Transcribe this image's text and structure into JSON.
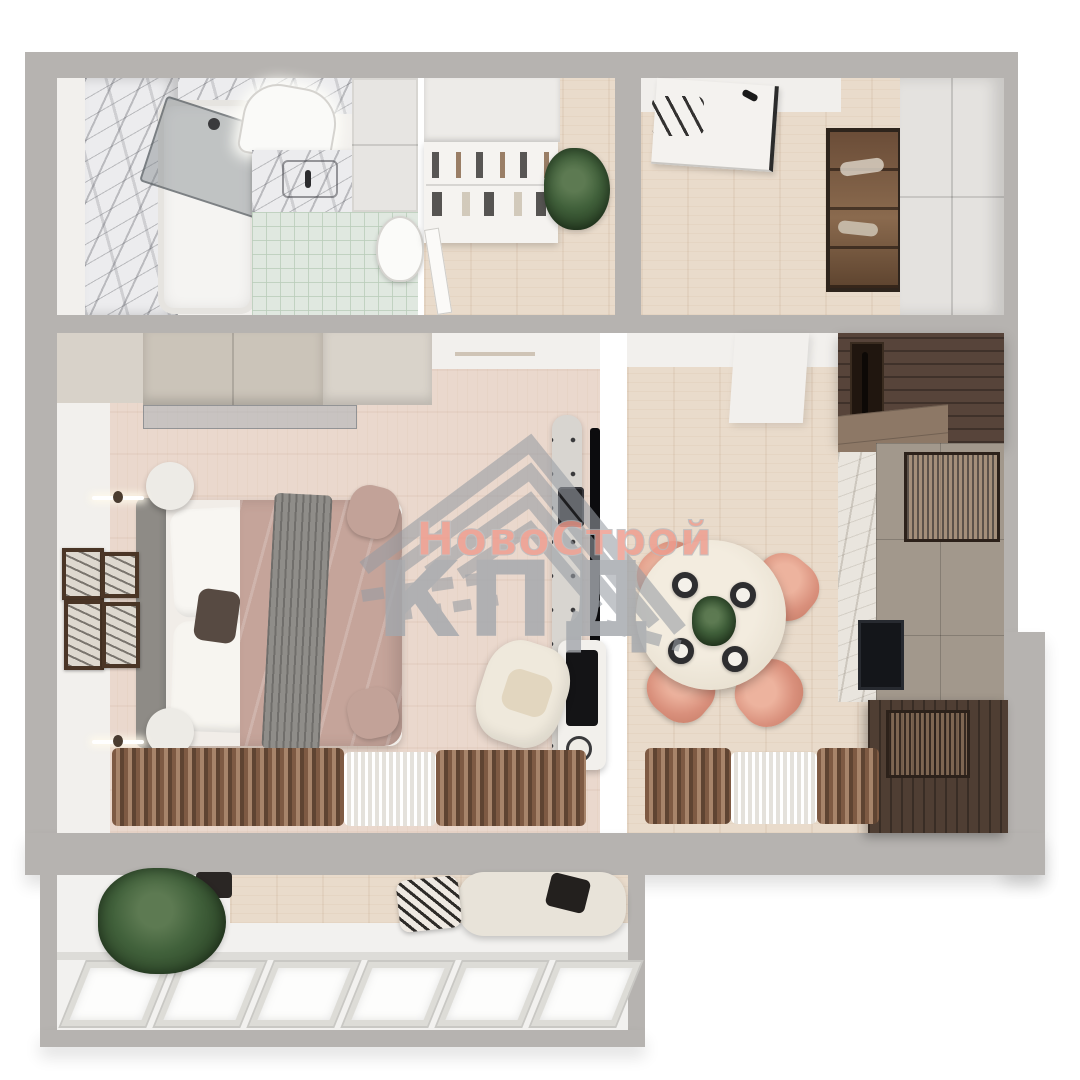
{
  "meta": {
    "kind": "3d-floorplan-render",
    "view": "top-down",
    "apartment": "one-bedroom"
  },
  "watermark": {
    "logo": "roof-chevron-logo",
    "brand_line1": "НовоСтрой",
    "brand_line2": "КПД"
  },
  "palette": {
    "bg": "#ffffff",
    "wall": "#b6b3b0",
    "white_wall": "#f2f0ed",
    "floor_wood": "#e9dbcb",
    "bedroom_floor": "#ead8cd",
    "marble": "#ececee",
    "mint_tile": "#e0e8e0",
    "walnut": "#57443a",
    "taupe": "#a2988c",
    "coral": "#d9907c",
    "mauve": "#c5a49a",
    "greige": "#cbc4b9",
    "curtain_brown": "#7e5a43",
    "plant_green": "#3f5e3b",
    "watermark_pink": "#ee9c8e",
    "watermark_gray": "#a4a8ad"
  },
  "rooms": [
    {
      "id": "bathroom",
      "objects": [
        "marble-walls",
        "bathtub",
        "glass-shower-screen",
        "led-mirror",
        "marble-vanity",
        "toilet",
        "mint-tile-floor",
        "white-storage-cabinets"
      ]
    },
    {
      "id": "hallway",
      "objects": [
        "built-in-wardrobe",
        "open-shelving-unit",
        "potted-plant",
        "wood-floor",
        "bathroom-door"
      ]
    },
    {
      "id": "entry-hall",
      "objects": [
        "front-door",
        "coat-hooks",
        "glass-shoe-cabinet",
        "tall-white-wardrobe",
        "wood-floor"
      ]
    },
    {
      "id": "bedroom",
      "objects": [
        "greige-wardrobe",
        "glass-partition",
        "double-bed",
        "white-pillows",
        "mauve-bedspread",
        "gray-throw",
        "round-nightstands",
        "wall-sconces",
        "gallery-wall-frames",
        "tv-panel",
        "media-console",
        "makeup-desk",
        "boucle-armchair",
        "brown-curtains",
        "sheer-curtains"
      ]
    },
    {
      "id": "living-kitchen",
      "objects": [
        "round-dining-table",
        "terracotta-chairs",
        "table-plates",
        "centerpiece-plant",
        "walnut-upper-cabinets",
        "marble-backsplash",
        "taupe-cabinets",
        "black-oven",
        "ribbed-glass-cabinets",
        "walnut-base-cabinet",
        "brown-curtains",
        "sheer-curtains"
      ]
    },
    {
      "id": "balcony",
      "objects": [
        "potted-plant",
        "lounge-chair",
        "patterned-pillow",
        "window-row"
      ]
    }
  ]
}
